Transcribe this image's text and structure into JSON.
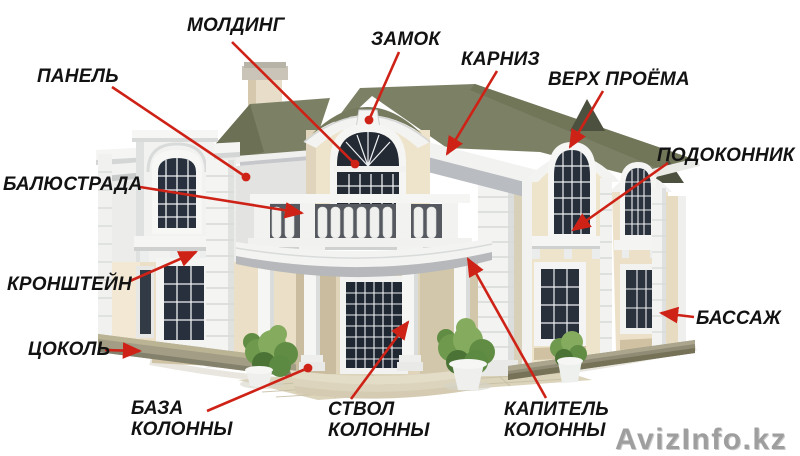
{
  "figure": {
    "type": "labeled-architecture-diagram",
    "subject": "facade decor elements of a classical two-story house"
  },
  "colors": {
    "arrow": "#ce2217",
    "label_text": "#121212",
    "watermark": "#9e9e9e",
    "roof": "#7c8166",
    "wall_cream": "#ebdfc7",
    "trim_white": "#f4f5f3",
    "glass": "#27303c"
  },
  "watermark": {
    "text": "AvizInfo.kz"
  },
  "labels": [
    {
      "id": "molding",
      "text": "МОЛДИНГ",
      "x": 187,
      "y": 15,
      "line": [
        232,
        42,
        355,
        164
      ],
      "tip": "dot"
    },
    {
      "id": "keystone",
      "text": "ЗАМОК",
      "x": 371,
      "y": 29,
      "line": [
        399,
        52,
        369,
        120
      ],
      "tip": "dot"
    },
    {
      "id": "cornice",
      "text": "КАРНИЗ",
      "x": 461,
      "y": 49,
      "line": [
        497,
        71,
        447,
        154
      ],
      "tip": "arrow"
    },
    {
      "id": "top-of-opening",
      "text": "ВЕРХ ПРОЁМА",
      "x": 548,
      "y": 69,
      "line": [
        603,
        91,
        570,
        147
      ],
      "tip": "arrow"
    },
    {
      "id": "windowsill",
      "text": "ПОДОКОННИК",
      "x": 657,
      "y": 145,
      "line": [
        668,
        163,
        573,
        230
      ],
      "tip": "arrow"
    },
    {
      "id": "panel",
      "text": "ПАНЕЛЬ",
      "x": 37,
      "y": 66,
      "line": [
        112,
        87,
        246,
        177
      ],
      "tip": "dot"
    },
    {
      "id": "balustrade",
      "text": "БАЛЮСТРАДА",
      "x": 3,
      "y": 174,
      "line": [
        140,
        187,
        302,
        213
      ],
      "tip": "arrow"
    },
    {
      "id": "bracket",
      "text": "КРОНШТЕЙН",
      "x": 7,
      "y": 274,
      "line": [
        130,
        281,
        196,
        252
      ],
      "tip": "arrow"
    },
    {
      "id": "bossage",
      "text": "БАССАЖ",
      "x": 696,
      "y": 308,
      "line": [
        694,
        317,
        661,
        313
      ],
      "tip": "arrow"
    },
    {
      "id": "plinth",
      "text": "ЦОКОЛЬ",
      "x": 28,
      "y": 339,
      "line": [
        105,
        350,
        140,
        351
      ],
      "tip": "arrow"
    },
    {
      "id": "column-base",
      "text": "БАЗА\nКОЛОННЫ",
      "x": 131,
      "y": 398,
      "line": [
        207,
        411,
        308,
        368
      ],
      "tip": "dot"
    },
    {
      "id": "column-shaft",
      "text": "СТВОЛ\nКОЛОННЫ",
      "x": 328,
      "y": 399,
      "line": [
        351,
        399,
        408,
        322
      ],
      "tip": "arrow"
    },
    {
      "id": "column-capital",
      "text": "КАПИТЕЛЬ\nКОЛОННЫ",
      "x": 504,
      "y": 399,
      "line": [
        546,
        398,
        468,
        259
      ],
      "tip": "arrow"
    }
  ]
}
